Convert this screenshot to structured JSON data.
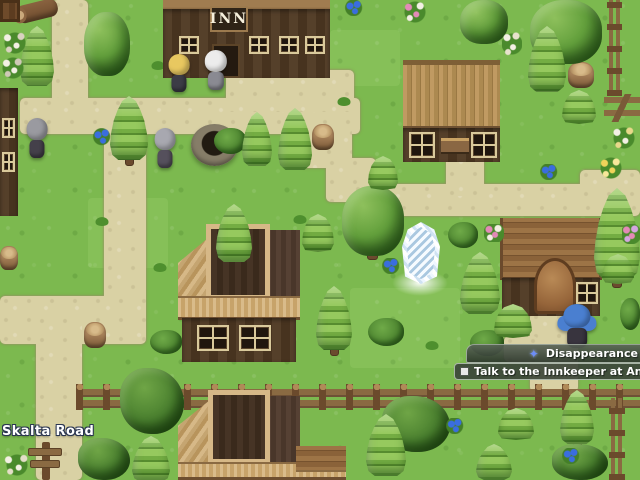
{
  "map": {
    "location_label": "Skalta Road"
  },
  "inn": {
    "sign_text": "INN"
  },
  "quest_tracker": {
    "title": "Disappearance",
    "marker_glyph": "✦",
    "objective": "Talk to the Innkeeper at Anemone V"
  },
  "icons": {
    "quest_marker": "blue-sparkle-icon",
    "task_bullet": "checkbox-icon"
  },
  "colors": {
    "grass": "#7cb94f",
    "path": "#d9d1a4",
    "hud_panel_bg": "rgba(58,68,56,0.9)",
    "hud_border": "#d7e1d7",
    "hud_text": "#ffffff",
    "quest_marker_blue": "#6d8df8",
    "roof_tan": "#b8945c",
    "wood_dark": "#47331f"
  }
}
